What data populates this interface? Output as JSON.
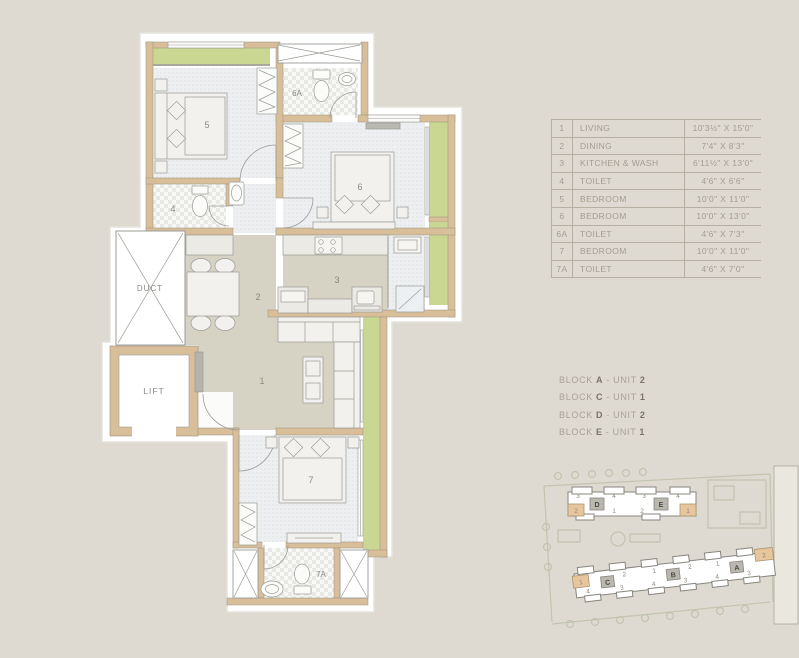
{
  "palette": {
    "background": "#dedad2",
    "wall": "#d8bf99",
    "balcony_green": "#c9d792",
    "floor_warm": "#d6d3c5",
    "floor_cool": "#edeff1",
    "line_grey": "#9b9b96",
    "highlight_orange": "#e8c69d",
    "text_muted": "#a49d90",
    "text_dark": "#7b7466"
  },
  "plan": {
    "duct": "DUCT",
    "lift": "LIFT",
    "living": "1",
    "dining": "2",
    "kitchen": "3",
    "toilet4": "4",
    "bed5": "5",
    "bed6": "6",
    "toilet6a": "6A",
    "bed7": "7",
    "toilet7a": "7A"
  },
  "dimension_table": {
    "rows": [
      {
        "no": "1",
        "name": "LIVING",
        "size": "10'3½\" X 15'0\""
      },
      {
        "no": "2",
        "name": "DINING",
        "size": "7'4\" X 8'3\""
      },
      {
        "no": "3",
        "name": "KITCHEN & WASH",
        "size": "6'11½\" X 13'0\""
      },
      {
        "no": "4",
        "name": "TOILET",
        "size": "4'6\" X 6'6\""
      },
      {
        "no": "5",
        "name": "BEDROOM",
        "size": "10'0\" X 11'0\""
      },
      {
        "no": "6",
        "name": "BEDROOM",
        "size": "10'0\" X 13'0\""
      },
      {
        "no": "6A",
        "name": "TOILET",
        "size": "4'6\" X 7'3\""
      },
      {
        "no": "7",
        "name": "BEDROOM",
        "size": "10'0\" X 11'0\""
      },
      {
        "no": "7A",
        "name": "TOILET",
        "size": "4'6\" X 7'0\""
      }
    ]
  },
  "block_units": [
    {
      "word": "BLOCK",
      "letter": "A",
      "sep": "- UNIT",
      "unit": "2"
    },
    {
      "word": "BLOCK",
      "letter": "C",
      "sep": "- UNIT",
      "unit": "1"
    },
    {
      "word": "BLOCK",
      "letter": "D",
      "sep": "- UNIT",
      "unit": "2"
    },
    {
      "word": "BLOCK",
      "letter": "E",
      "sep": "- UNIT",
      "unit": "1"
    }
  ],
  "site_plan": {
    "top_d": {
      "letter": "D",
      "t": [
        "3",
        "4"
      ],
      "b": [
        "2",
        "1"
      ]
    },
    "top_e": {
      "letter": "E",
      "t": [
        "3",
        "4"
      ],
      "b": [
        "2",
        "1"
      ]
    },
    "bottom": {
      "letters": [
        "C",
        "B",
        "A"
      ],
      "t": [
        "1",
        "2",
        "1",
        "2",
        "1",
        "2"
      ],
      "b": [
        "4",
        "3",
        "4",
        "3",
        "4",
        "3"
      ]
    }
  }
}
